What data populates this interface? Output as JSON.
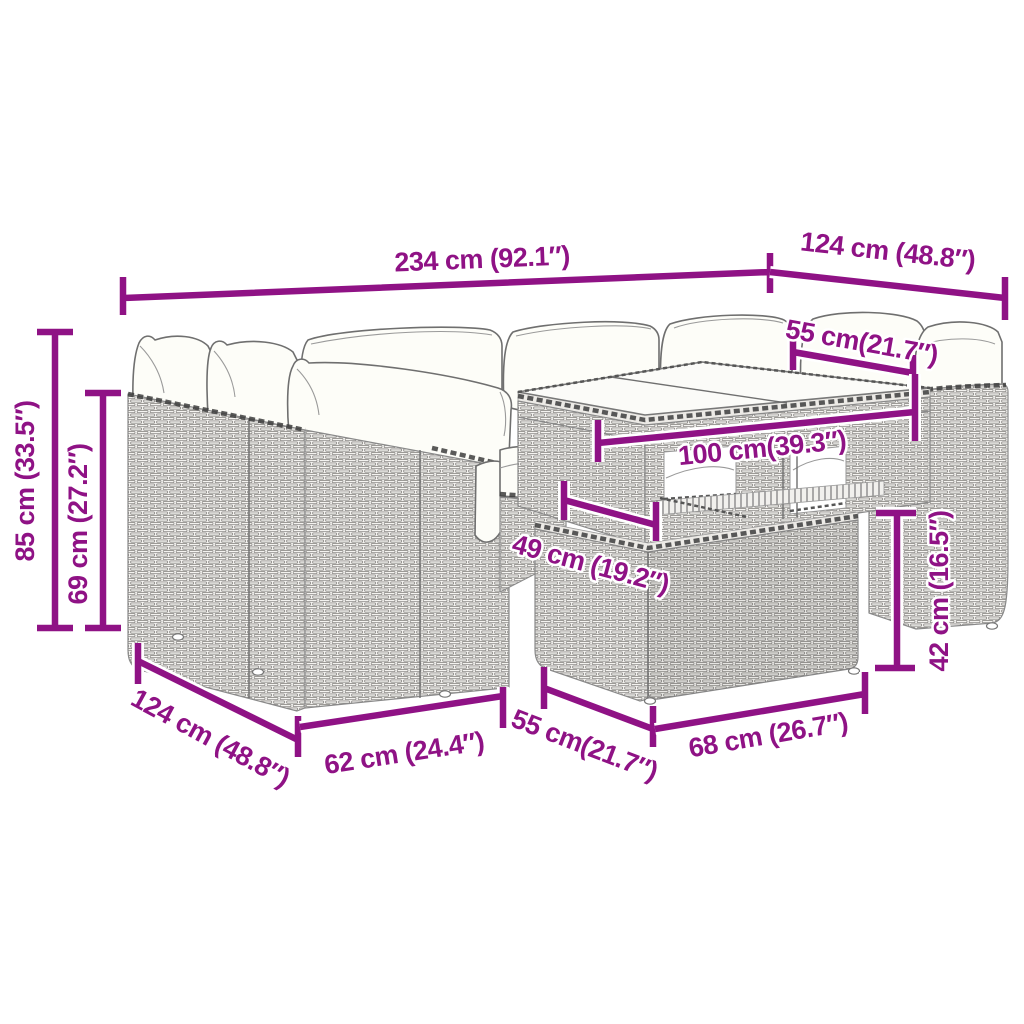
{
  "diagram": {
    "type": "product-dimension-diagram",
    "subject": "rattan-garden-lounge-set-with-table-and-ottoman",
    "background_color": "#ffffff",
    "dimension_color": "#8F1285",
    "line_art_color": "#6f6f6f",
    "rattan_line_color": "#8a8a8a",
    "cushion_color": "#fdfdf8",
    "glass_color": "#fbfbf8",
    "units": [
      "cm",
      "inches"
    ],
    "dimensions": [
      {
        "id": "overall-width",
        "label": "234 cm (92.1″)",
        "cm": 234,
        "inches": 92.1
      },
      {
        "id": "overall-depth-right",
        "label": "124 cm (48.8″)",
        "cm": 124,
        "inches": 48.8
      },
      {
        "id": "right-seat-width",
        "label": "55 cm(21.7″)",
        "cm": 55,
        "inches": 21.7
      },
      {
        "id": "overall-height",
        "label": "85 cm (33.5″)",
        "cm": 85,
        "inches": 33.5
      },
      {
        "id": "backrest-height",
        "label": "69 cm (27.2″)",
        "cm": 69,
        "inches": 27.2
      },
      {
        "id": "table-width",
        "label": "100 cm(39.3″)",
        "cm": 100,
        "inches": 39.3
      },
      {
        "id": "table-depth",
        "label": "49 cm (19.2″)",
        "cm": 49,
        "inches": 19.2
      },
      {
        "id": "ottoman-height",
        "label": "42 cm (16.5″)",
        "cm": 42,
        "inches": 16.5
      },
      {
        "id": "overall-depth-left",
        "label": "124 cm (48.8″)",
        "cm": 124,
        "inches": 48.8
      },
      {
        "id": "module-width",
        "label": "62 cm (24.4″)",
        "cm": 62,
        "inches": 24.4
      },
      {
        "id": "ottoman-depth",
        "label": "55 cm(21.7″)",
        "cm": 55,
        "inches": 21.7
      },
      {
        "id": "ottoman-width",
        "label": "68 cm (26.7″)",
        "cm": 68,
        "inches": 26.7
      }
    ]
  }
}
